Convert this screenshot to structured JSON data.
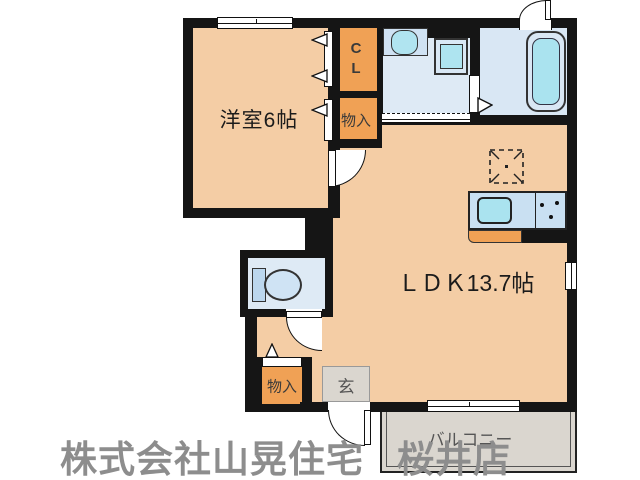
{
  "floorplan": {
    "rooms": {
      "western_room": "洋室6帖",
      "ldk": "ＬＤＫ13.7帖",
      "closet": "CL",
      "storage_top": "物入",
      "storage_bottom": "物入",
      "entrance": "玄",
      "balcony": "バルコニー"
    },
    "colors": {
      "wall": "#151515",
      "room_floor": "#f4cda5",
      "closet_fill": "#f0a155",
      "wet_area": "#deeaf5",
      "bath_area": "#d9e7f4",
      "fixture_water": "#aae3ef",
      "tile_gray": "#dad6cf",
      "watermark_gray": "#8d8d8d"
    }
  },
  "watermark": {
    "company": "株式会社山晃住宅",
    "branch": "桜井店"
  }
}
